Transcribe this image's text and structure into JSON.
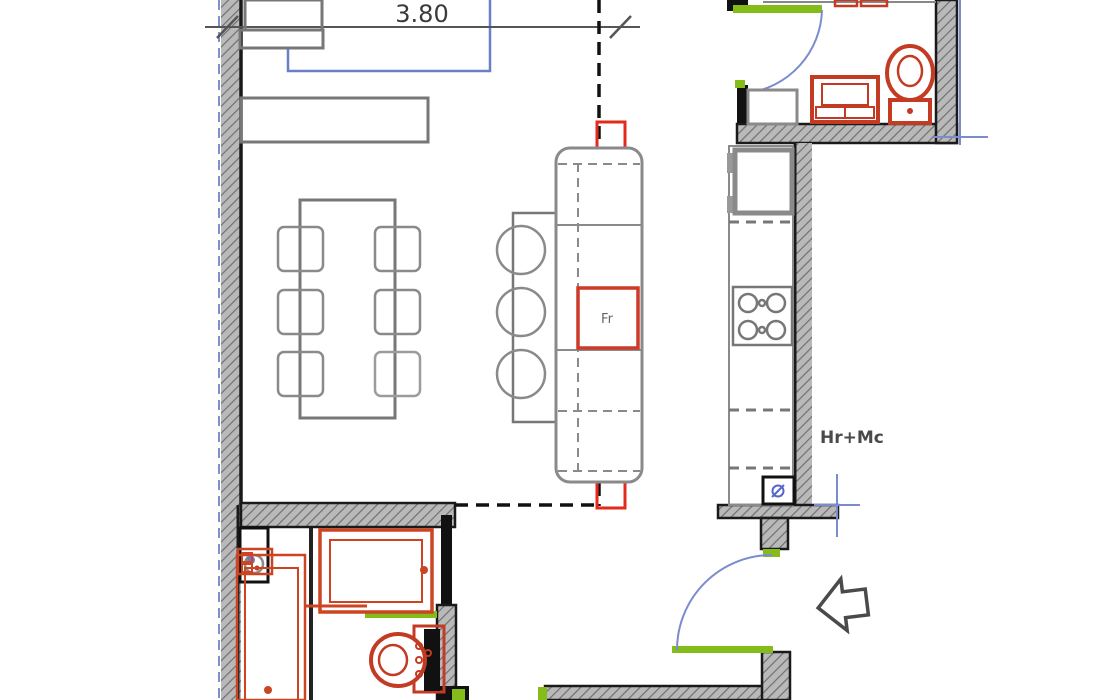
{
  "plan": {
    "dimension_label": "3.80",
    "fridge_label": "Fr",
    "utility_label": "Hr+Mc"
  },
  "colors": {
    "fixture_red": "#c23b22",
    "vent_red": "#e42a1d",
    "door_green": "#84bd1a",
    "arc_blue": "#7a8ccd",
    "window_blue": "#6b7fc7",
    "wall_hatch_gray": "#b9b9b9",
    "wall_edge_black": "#1a1a1a",
    "furniture_gray": "#777777"
  },
  "icons": {
    "entry_arrow": "left-block-arrow",
    "section_line": "dashed-section-line"
  },
  "rooms": {
    "living_dining": "open plan with dining table, 6 chairs, bar counter, 3 stools, island with fridge",
    "kitchen": "counter run with sink, stove, boiler unit",
    "wc_top": "washbasin and toilet",
    "bathroom_bottom": "shower tray, walk-in shower, toilet, cabinet"
  }
}
